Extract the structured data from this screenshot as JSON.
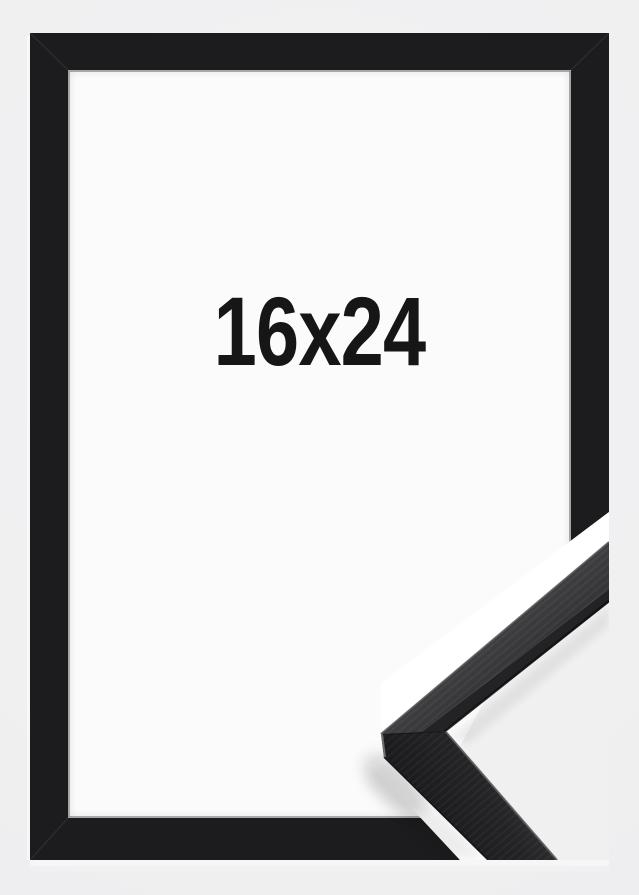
{
  "product": {
    "size_label": "16x24",
    "colors": {
      "background": "#f0f0f1",
      "frame": "#1c1c1e",
      "mat": "#fbfbfc",
      "divider": "#ffffff",
      "moulding_face": "#3a3a3c",
      "moulding_shadow_side": "#1d1d1f",
      "label_text": "#161617"
    }
  }
}
